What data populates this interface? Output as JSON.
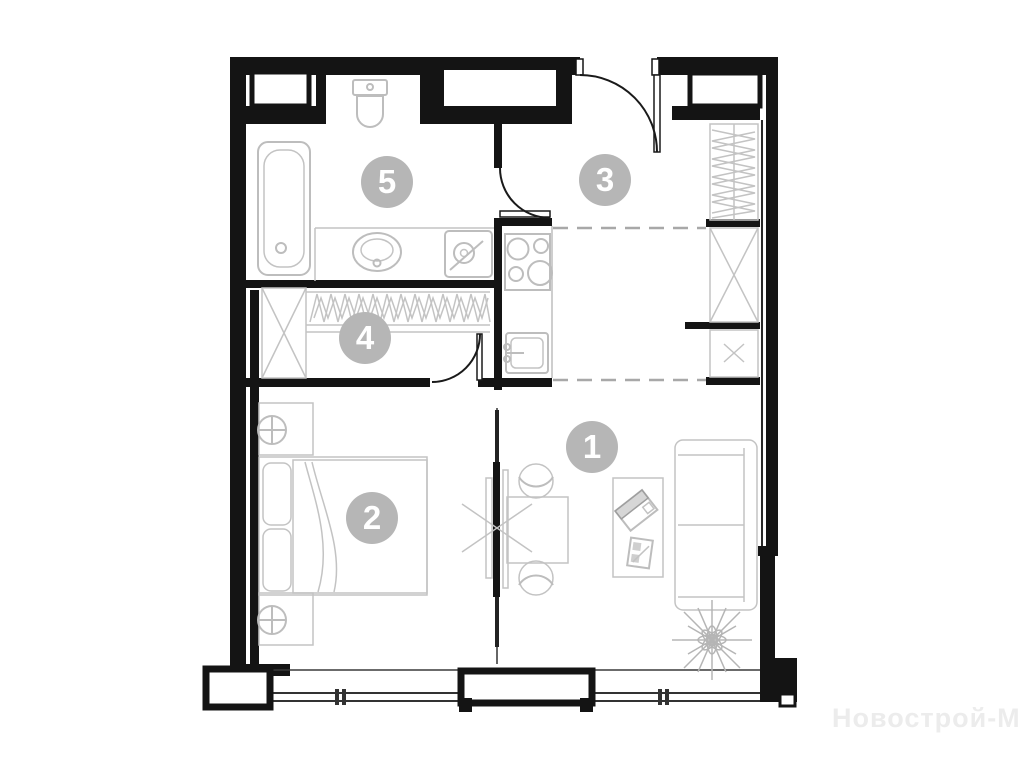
{
  "floor_plan": {
    "rooms": [
      {
        "number": "1",
        "name": "living-room"
      },
      {
        "number": "2",
        "name": "bedroom"
      },
      {
        "number": "3",
        "name": "hallway"
      },
      {
        "number": "4",
        "name": "walk-in-closet"
      },
      {
        "number": "5",
        "name": "bathroom"
      }
    ],
    "colors": {
      "wall": "#141414",
      "fixture": "#bdbdbd",
      "badge": "#b6b6b6",
      "badge_text": "#ffffff",
      "dashed_zone": "#a8a8a8",
      "watermark": "#ececec"
    },
    "fixtures": [
      "bathtub",
      "toilet",
      "vanity-sink",
      "washing-machine",
      "hanging-rail",
      "shelf-unit",
      "kitchen-stove",
      "kitchen-sink",
      "double-bed",
      "pillows",
      "nightstand-lamps",
      "sliding-partition",
      "dining-table",
      "chairs",
      "coffee-table",
      "laptop",
      "sofa",
      "plant",
      "entrance-door",
      "interior-doors",
      "panoramic-windows"
    ]
  },
  "watermark": {
    "text": "Новострой-М"
  }
}
